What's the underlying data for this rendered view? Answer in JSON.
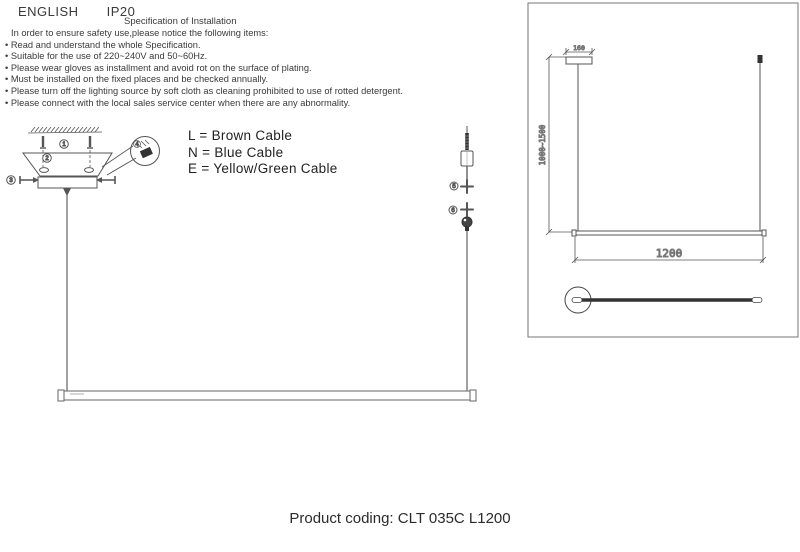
{
  "header": {
    "language": "ENGLISH",
    "ip_rating": "IP20"
  },
  "spec": {
    "title": "Specification of Installation",
    "intro": "In order to ensure safety use,please notice the following items:",
    "items": [
      "• Read and understand the whole Specification.",
      "• Suitable for the use of 220~240V and 50~60Hz.",
      "• Please wear gloves as installment and avoid rot on the surface of plating.",
      "• Must be installed on the fixed places and be checked annually.",
      "• Please turn off the lighting source by soft cloth as cleaning prohibited to use of rotted detergent.",
      "• Please connect with the local sales service center when there are any abnormality."
    ]
  },
  "cable_legend": {
    "lines": [
      "L = Brown Cable",
      "N = Blue Cable",
      "E = Yellow/Green Cable"
    ]
  },
  "installation_diagram": {
    "callouts": [
      "1",
      "2",
      "3",
      "4",
      "5",
      "6"
    ]
  },
  "dimension_diagram": {
    "canopy_width": "160",
    "suspension_height": "1000~1500",
    "fixture_length": "1200"
  },
  "footer": {
    "product_coding": "Product coding: CLT 035C L1200"
  },
  "colors": {
    "line": "#555555",
    "dark": "#333333",
    "text": "#333333"
  }
}
